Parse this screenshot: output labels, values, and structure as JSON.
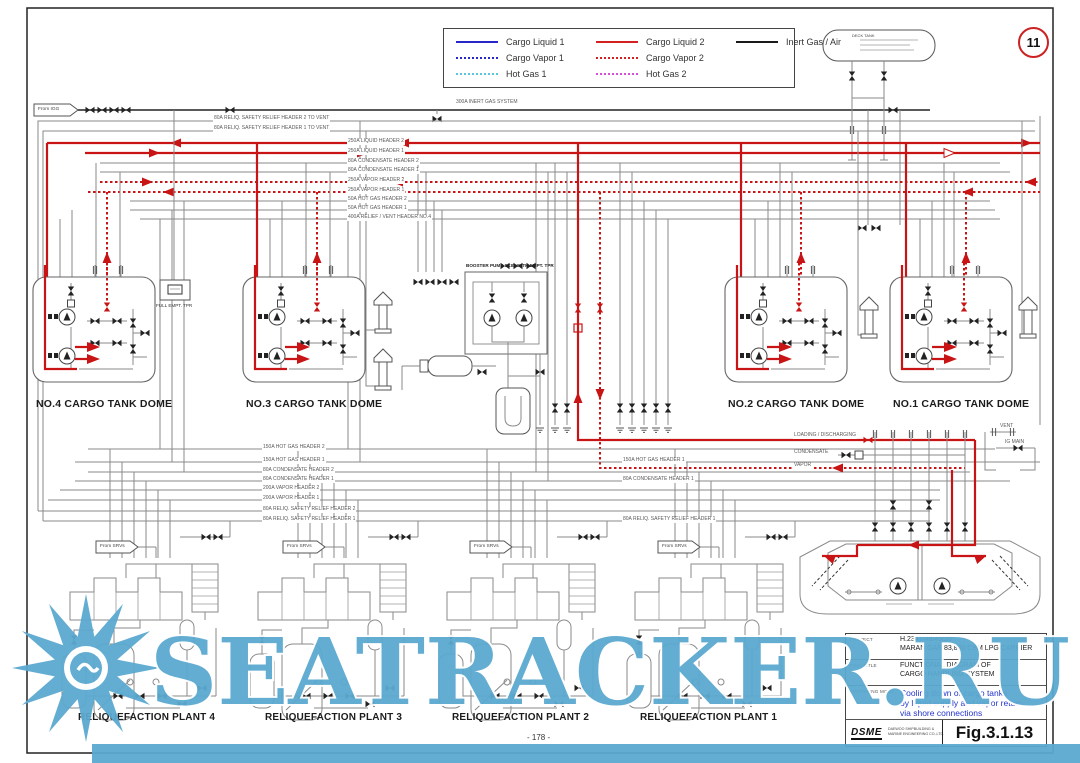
{
  "page": {
    "sheet_circle": "11",
    "page_number": "- 178 -",
    "watermark_text": "SEATRACKER.RU"
  },
  "legend": {
    "items": [
      {
        "label": "Cargo Liquid 1",
        "color": "#2626c9",
        "style": "solid"
      },
      {
        "label": "Cargo Vapor 1",
        "color": "#2626c9",
        "style": "dotted"
      },
      {
        "label": "Hot Gas 1",
        "color": "#57c7e3",
        "style": "dotted"
      },
      {
        "label": "Cargo Liquid 2",
        "color": "#d42020",
        "style": "solid"
      },
      {
        "label": "Cargo Vapor 2",
        "color": "#d42020",
        "style": "dotted"
      },
      {
        "label": "Hot Gas 2",
        "color": "#d94fd9",
        "style": "dotted"
      },
      {
        "label": "Inert Gas / Air",
        "color": "#1a1a1a",
        "style": "solid"
      }
    ]
  },
  "flags": {
    "from_igg": "From IGG",
    "from_srvs": "From SRVs"
  },
  "top_headers": {
    "inert_gas": "300A INERT GAS SYSTEM",
    "relief2": "80A RELIQ. SAFETY RELIEF HEADER 2 TO VENT",
    "relief1": "80A RELIQ. SAFETY RELIEF HEADER 1 TO VENT",
    "rows": [
      "250A LIQUID HEADER 2",
      "250A LIQUID HEADER 1",
      "80A CONDENSATE HEADER 2",
      "80A CONDENSATE HEADER 1",
      "250A VAPOR HEADER 2",
      "250A VAPOR HEADER 1",
      "50A HOT GAS HEADER 2",
      "50A HOT GAS HEADER 1",
      "400A RELIEF / VENT HEADER NO.4"
    ]
  },
  "mid_headers": {
    "rows": [
      "150A HOT GAS HEADER 2",
      "150A HOT GAS HEADER 1",
      "80A CONDENSATE HEADER 2",
      "80A CONDENSATE HEADER 1",
      "200A VAPOR HEADER 2",
      "200A VAPOR HEADER 1",
      "80A RELIQ. SAFETY RELIEF HEADER 2",
      "80A RELIQ. SAFETY RELIEF HEADER 1"
    ],
    "right_rows": [
      "150A HOT GAS HEADER 1",
      "80A CONDENSATE HEADER 1",
      "80A RELIQ. SAFETY RELIEF HEADER 1"
    ]
  },
  "domes": [
    {
      "label": "NO.4 CARGO TANK DOME"
    },
    {
      "label": "NO.3 CARGO TANK DOME"
    },
    {
      "label": "NO.2 CARGO TANK DOME"
    },
    {
      "label": "NO.1 CARGO TANK DOME"
    }
  ],
  "plants": [
    {
      "label": "RELIQUEFACTION PLANT 4"
    },
    {
      "label": "RELIQUEFACTION PLANT 3"
    },
    {
      "label": "RELIQUEFACTION PLANT 2"
    },
    {
      "label": "RELIQUEFACTION PLANT 1"
    }
  ],
  "equipment": {
    "booster_skid": "BOOSTER PUMP SKID WITH EMPT. TPR",
    "full_empt_tpr": "FULL EMPT. TPR",
    "deck_tank": "DECK TANK"
  },
  "manifold": {
    "loading": "LOADING / DISCHARGING",
    "condensate": "CONDENSATE",
    "vapor": "VAPOR",
    "vent": "VENT",
    "ig_main": "IG MAIN"
  },
  "titleblock": {
    "project_label": "PROJECT",
    "project_line1": "H.2347/48/49/20",
    "project_line2": "MARAN GAS 83,800 CBM LPG CARRIER",
    "dwg_label": "DWG TITLE",
    "dwg_line1": "FUNCTIONAL DIAGRAM OF",
    "dwg_line2": "CARGO HANDLING SYSTEM",
    "mode_label": "OPERATING MODE",
    "mode_line1": "Cooling down of cargo tanks",
    "mode_line2": "by liquid supply and vapor return",
    "mode_line3": "via shore connections",
    "company_logo": "DSME",
    "company_line1": "DAEWOO SHIPBUILDING &",
    "company_line2": "MARINE ENGINEERING CO.,LTD.",
    "fig": "Fig.3.1.13",
    "mode_color": "#2233cc"
  },
  "colors": {
    "pipe_gray": "#8a8a8a",
    "line_red": "#c81414",
    "watermark_blue": "#5ba9d0"
  }
}
